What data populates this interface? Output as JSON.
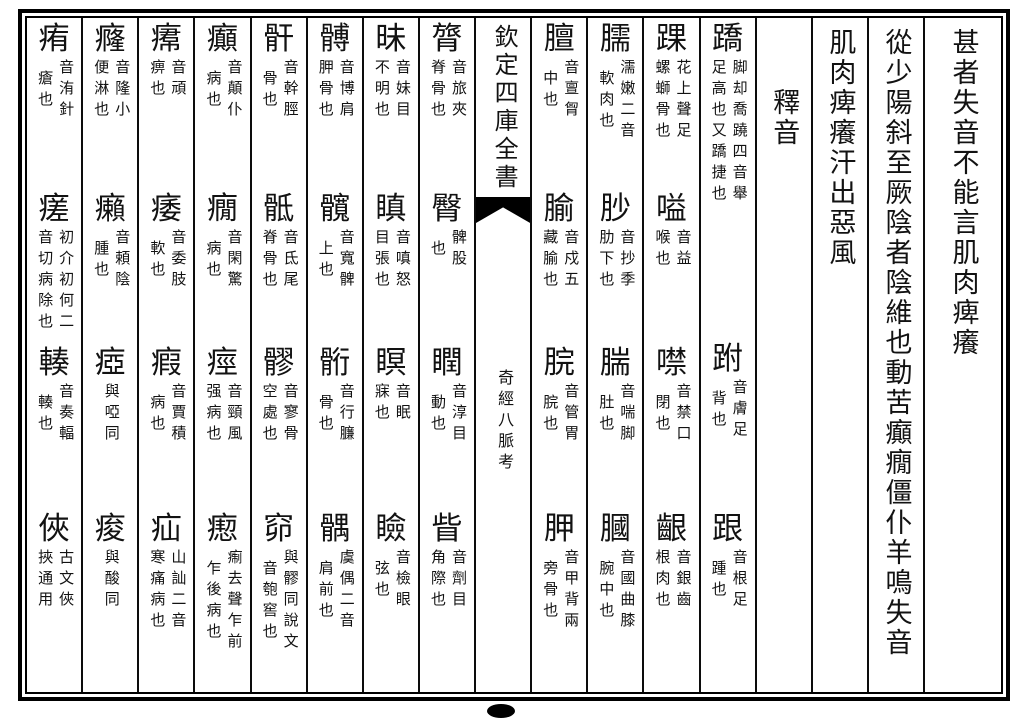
{
  "page_type": "woodblock-print-book-page",
  "columns": [
    {
      "type": "text",
      "name": "main-text-line-1",
      "wide": true,
      "text": "甚者失音不能言肌肉痺癢"
    },
    {
      "type": "text",
      "name": "main-text-line-2",
      "text": "從少陽斜至厥陰者陰維也動苦癲癇僵仆羊鳴失音"
    },
    {
      "type": "text",
      "name": "main-text-line-3",
      "text": "肌肉痺癢汗出惡風"
    },
    {
      "type": "text",
      "name": "section-heading",
      "top_offset": true,
      "text": "釋音"
    },
    {
      "type": "gloss",
      "entries": [
        {
          "head": "蹻",
          "note": "脚却喬蹺四音舉足高也又蹻捷也"
        },
        {
          "head": "跗",
          "note": "音膚足背也"
        },
        {
          "head": "跟",
          "note": "音根足踵也"
        }
      ]
    },
    {
      "type": "gloss",
      "entries": [
        {
          "head": "踝",
          "note": "花上聲足螺螄骨也"
        },
        {
          "head": "嗌",
          "note": "音益喉也"
        },
        {
          "head": "噤",
          "note": "音禁口閉也"
        },
        {
          "head": "齦",
          "note": "音銀齒根肉也"
        }
      ]
    },
    {
      "type": "gloss",
      "entries": [
        {
          "head": "臑",
          "note": "濡嫩二音軟肉也"
        },
        {
          "head": "䏚",
          "note": "音抄季肋下也"
        },
        {
          "head": "腨",
          "note": "音喘脚肚也"
        },
        {
          "head": "膕",
          "note": "音國曲膝腕中也"
        }
      ]
    },
    {
      "type": "gloss",
      "entries": [
        {
          "head": "膻",
          "note": "音亶胷中也"
        },
        {
          "head": "腧",
          "note": "音戍五藏腧也"
        },
        {
          "head": "脘",
          "note": "音管胃脘也"
        },
        {
          "head": "胛",
          "note": "音甲背兩旁骨也"
        }
      ]
    },
    {
      "type": "gutter",
      "book_title": "欽定四庫全書",
      "work_title": "奇經八脈考",
      "fishtail_icon": "black-fishtail"
    },
    {
      "type": "gloss",
      "entries": [
        {
          "head": "膂",
          "note": "音旅夾脊骨也"
        },
        {
          "head": "臀",
          "note": "髀股也"
        },
        {
          "head": "瞤",
          "note": "音淳目動也"
        },
        {
          "head": "眥",
          "note": "音劑目角際也"
        }
      ]
    },
    {
      "type": "gloss",
      "entries": [
        {
          "head": "昧",
          "note": "音妹目不明也"
        },
        {
          "head": "瞋",
          "note": "音嗔怒目張也"
        },
        {
          "head": "瞑",
          "note": "音眠寐也"
        },
        {
          "head": "瞼",
          "note": "音檢眼弦也"
        }
      ]
    },
    {
      "type": "gloss",
      "entries": [
        {
          "head": "髆",
          "note": "音博肩胛骨也"
        },
        {
          "head": "髖",
          "note": "音寬髀上也"
        },
        {
          "head": "䯒",
          "note": "音行臁骨也"
        },
        {
          "head": "髃",
          "note": "虞偶二音肩前也"
        }
      ]
    },
    {
      "type": "gloss",
      "entries": [
        {
          "head": "骭",
          "note": "音幹脛骨也"
        },
        {
          "head": "骶",
          "note": "音氐尾脊骨也"
        },
        {
          "head": "髎",
          "note": "音寥骨空處也"
        },
        {
          "head": "窌",
          "note": "與髎同說文音匏窖也"
        }
      ]
    },
    {
      "type": "gloss",
      "entries": [
        {
          "head": "癲",
          "note": "音顛仆病也"
        },
        {
          "head": "癇",
          "note": "音閑驚病也"
        },
        {
          "head": "痙",
          "note": "音頸風强病也"
        },
        {
          "head": "瘛",
          "note": "痸去聲乍前乍後病也"
        }
      ]
    },
    {
      "type": "gloss",
      "entries": [
        {
          "head": "𤸷",
          "note": "音頑痹也"
        },
        {
          "head": "痿",
          "note": "音委肢軟也"
        },
        {
          "head": "瘕",
          "note": "音賈積病也"
        },
        {
          "head": "疝",
          "note": "山訕二音寒痛病也"
        }
      ]
    },
    {
      "type": "gloss",
      "entries": [
        {
          "head": "癃",
          "note": "音隆小便淋也"
        },
        {
          "head": "癩",
          "note": "音頼陰腫也"
        },
        {
          "head": "瘂",
          "note": "與啞同",
          "rows": 3
        },
        {
          "head": "痠",
          "note": "與酸同",
          "rows": 3
        }
      ]
    },
    {
      "type": "gloss",
      "entries": [
        {
          "head": "痏",
          "note": "音洧針瘡也"
        },
        {
          "head": "瘥",
          "note": "初介初何二音切病除也"
        },
        {
          "head": "輳",
          "note": "音奏輻輳也"
        },
        {
          "head": "俠",
          "note": "古文俠挾通用"
        }
      ]
    }
  ],
  "page_edge_mark": "ink-dot"
}
